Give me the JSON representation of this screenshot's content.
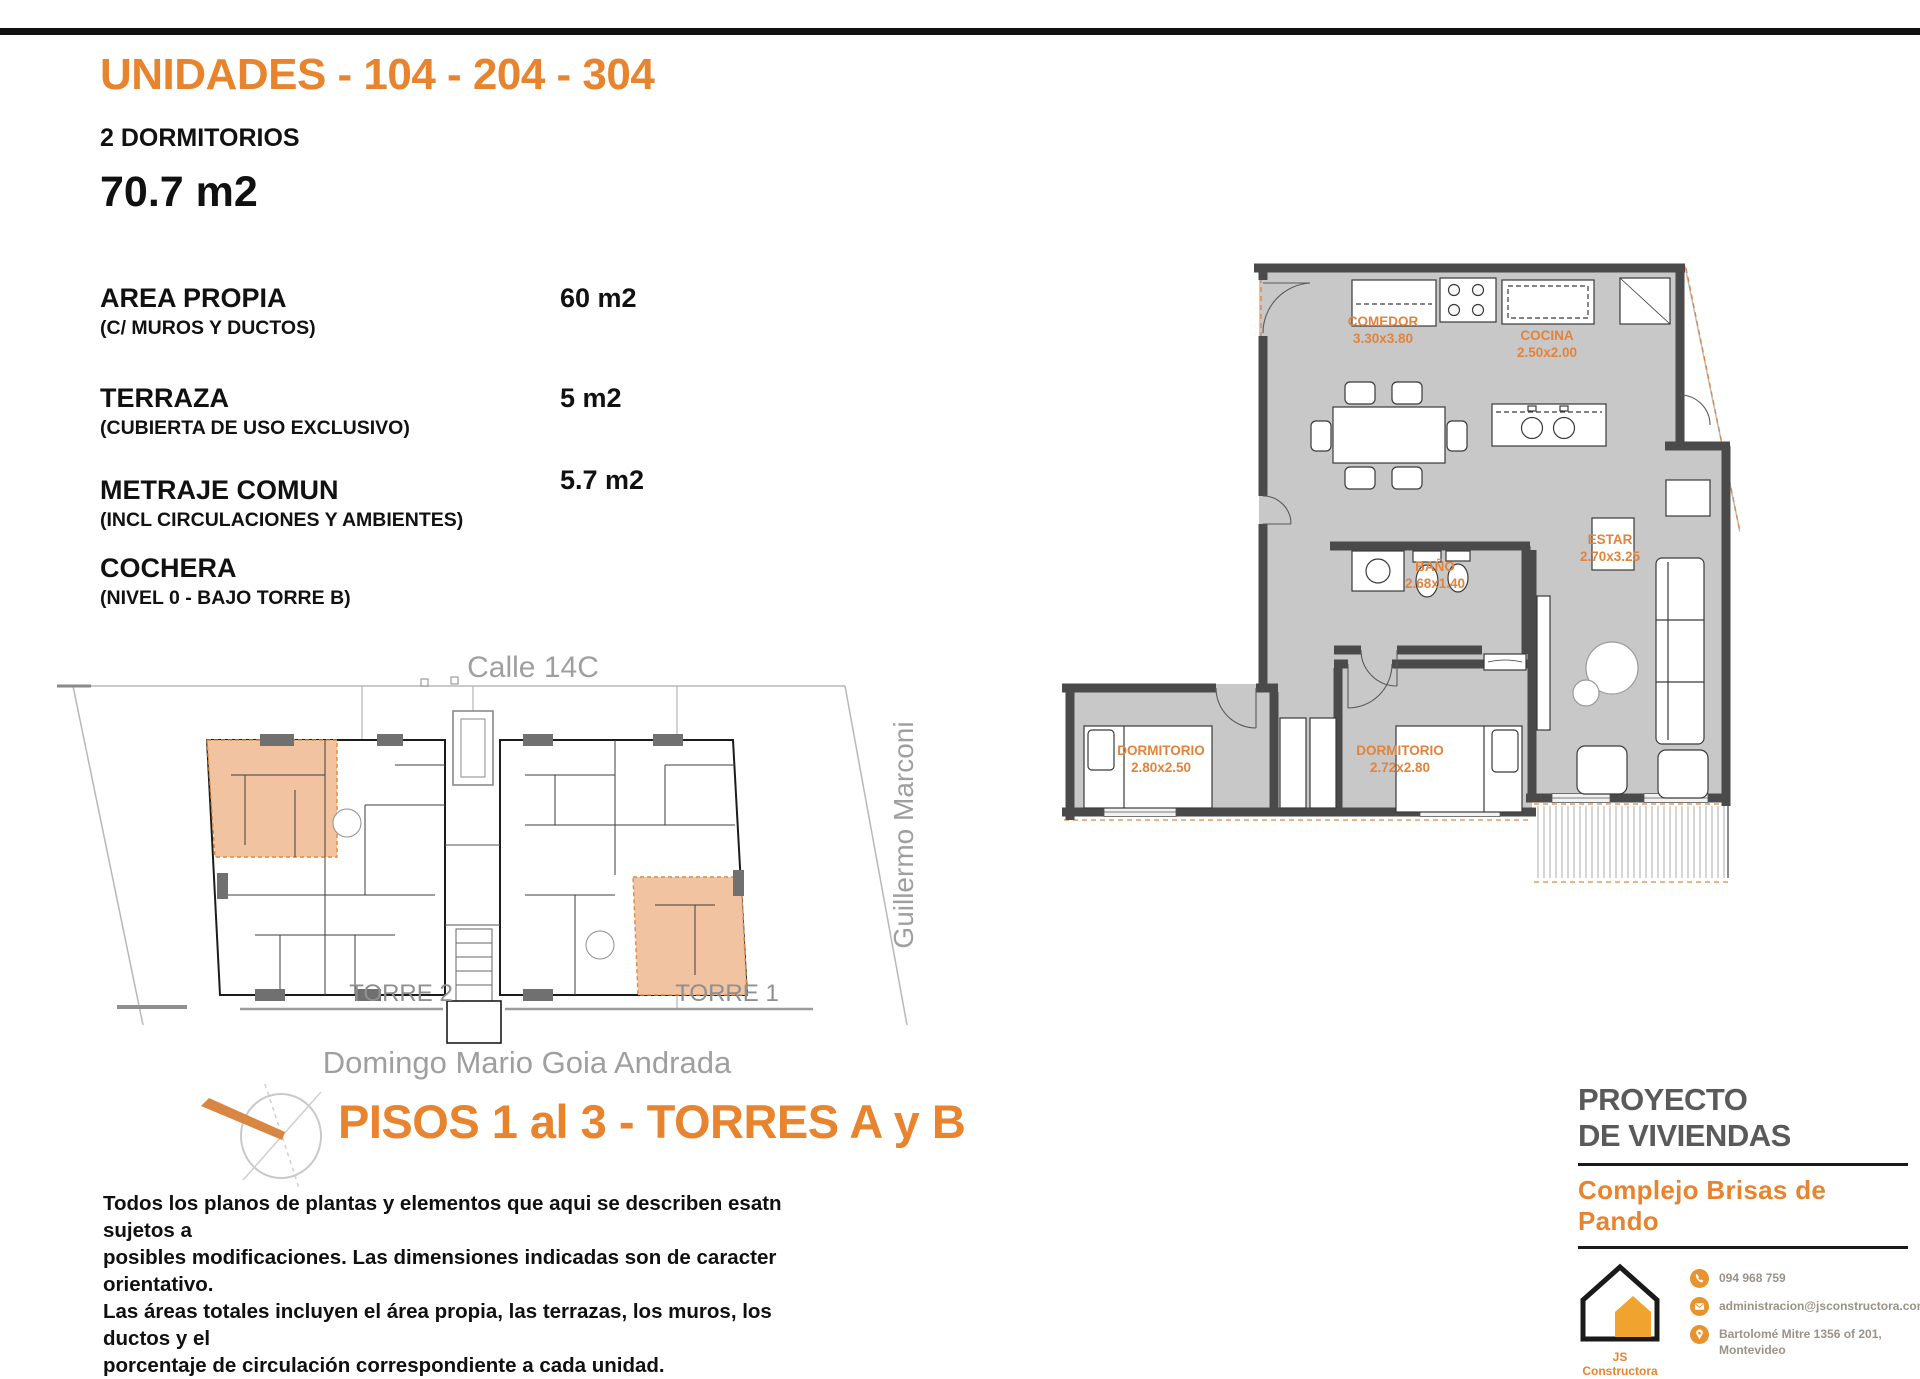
{
  "header": {
    "title": "UNIDADES - 104 - 204 - 304",
    "subtitle": "2 DORMITORIOS",
    "total_area": "70.7 m2"
  },
  "specs": {
    "rows": [
      {
        "label": "AREA PROPIA",
        "sublabel": "(C/ MUROS Y DUCTOS)",
        "value": "60 m2"
      },
      {
        "label": "TERRAZA",
        "sublabel": "(CUBIERTA DE USO EXCLUSIVO)",
        "value": "5 m2"
      },
      {
        "label": "METRAJE COMUN",
        "sublabel": "(INCL CIRCULACIONES Y AMBIENTES)",
        "value": "5.7 m2"
      },
      {
        "label": "COCHERA",
        "sublabel": "(NIVEL 0 - BAJO TORRE B)",
        "value": ""
      }
    ]
  },
  "site_plan": {
    "street_top": "Calle 14C",
    "street_right": "Guillermo Marconi",
    "street_bottom": "Domingo Mario Goia Andrada",
    "tower_left": "TORRE 2",
    "tower_right": "TORRE 1"
  },
  "floor_plan": {
    "rooms": [
      {
        "name": "COMEDOR",
        "dims": "3.30x3.80"
      },
      {
        "name": "COCINA",
        "dims": "2.50x2.00"
      },
      {
        "name": "BAÑO",
        "dims": "2.68x1.40"
      },
      {
        "name": "ESTAR",
        "dims": "2.70x3.25"
      },
      {
        "name": "DORMITORIO",
        "dims": "2.80x2.50"
      },
      {
        "name": "DORMITORIO",
        "dims": "2.72x2.80"
      }
    ]
  },
  "footer_left": {
    "heading": "PISOS 1 al 3 - TORRES A y B",
    "disclaimer_lines": [
      "Todos los planos de plantas y elementos que aqui se describen esatn sujetos a",
      "posibles modificaciones.  Las dimensiones indicadas son de caracter orientativo.",
      "Las áreas totales incluyen el área propia, las terrazas, los muros, los ductos y el",
      "porcentaje de circulación correspondiente a cada unidad."
    ]
  },
  "footer_right": {
    "project_line1": "PROYECTO",
    "project_line2": "DE VIVIENDAS",
    "complex_name": "Complejo Brisas de Pando",
    "company": "JS Constructora",
    "contacts": {
      "phone": "094 968 759",
      "email": "administracion@jsconstructora.com",
      "address_line1": "Bartolomé Mitre 1356 of 201,",
      "address_line2": "Montevideo"
    }
  },
  "colors": {
    "accent": "#E8842E",
    "wall": "#4A4A4A",
    "floor": "#C8C8C8",
    "unit_highlight": "#F2C3A0",
    "gray_text": "#9C9C9C"
  }
}
